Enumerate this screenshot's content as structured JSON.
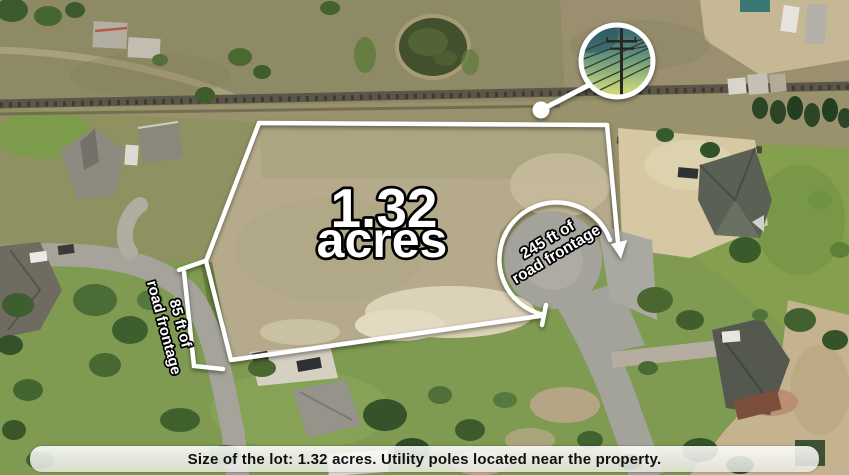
{
  "map": {
    "lot_label": {
      "value": "1.32",
      "unit": "acres"
    },
    "frontage_right": {
      "line1": "245 ft of",
      "line2": "road frontage"
    },
    "frontage_left": {
      "line1": "85 ft of",
      "line2": "road frontage"
    },
    "inset": {
      "icon": "utility-pole-icon",
      "subject": "utility pole with power lines"
    }
  },
  "caption": {
    "text": "Size of the lot: 1.32 acres. Utility poles located near the property."
  },
  "colors": {
    "annotation": "#ffffff",
    "annotation_outline": "#000000",
    "caption_background": "#f2f2ee",
    "caption_text": "#101010",
    "lot_field": "#b5aa8b",
    "road": "#a6a49c",
    "lawn": "#7e9b51"
  }
}
